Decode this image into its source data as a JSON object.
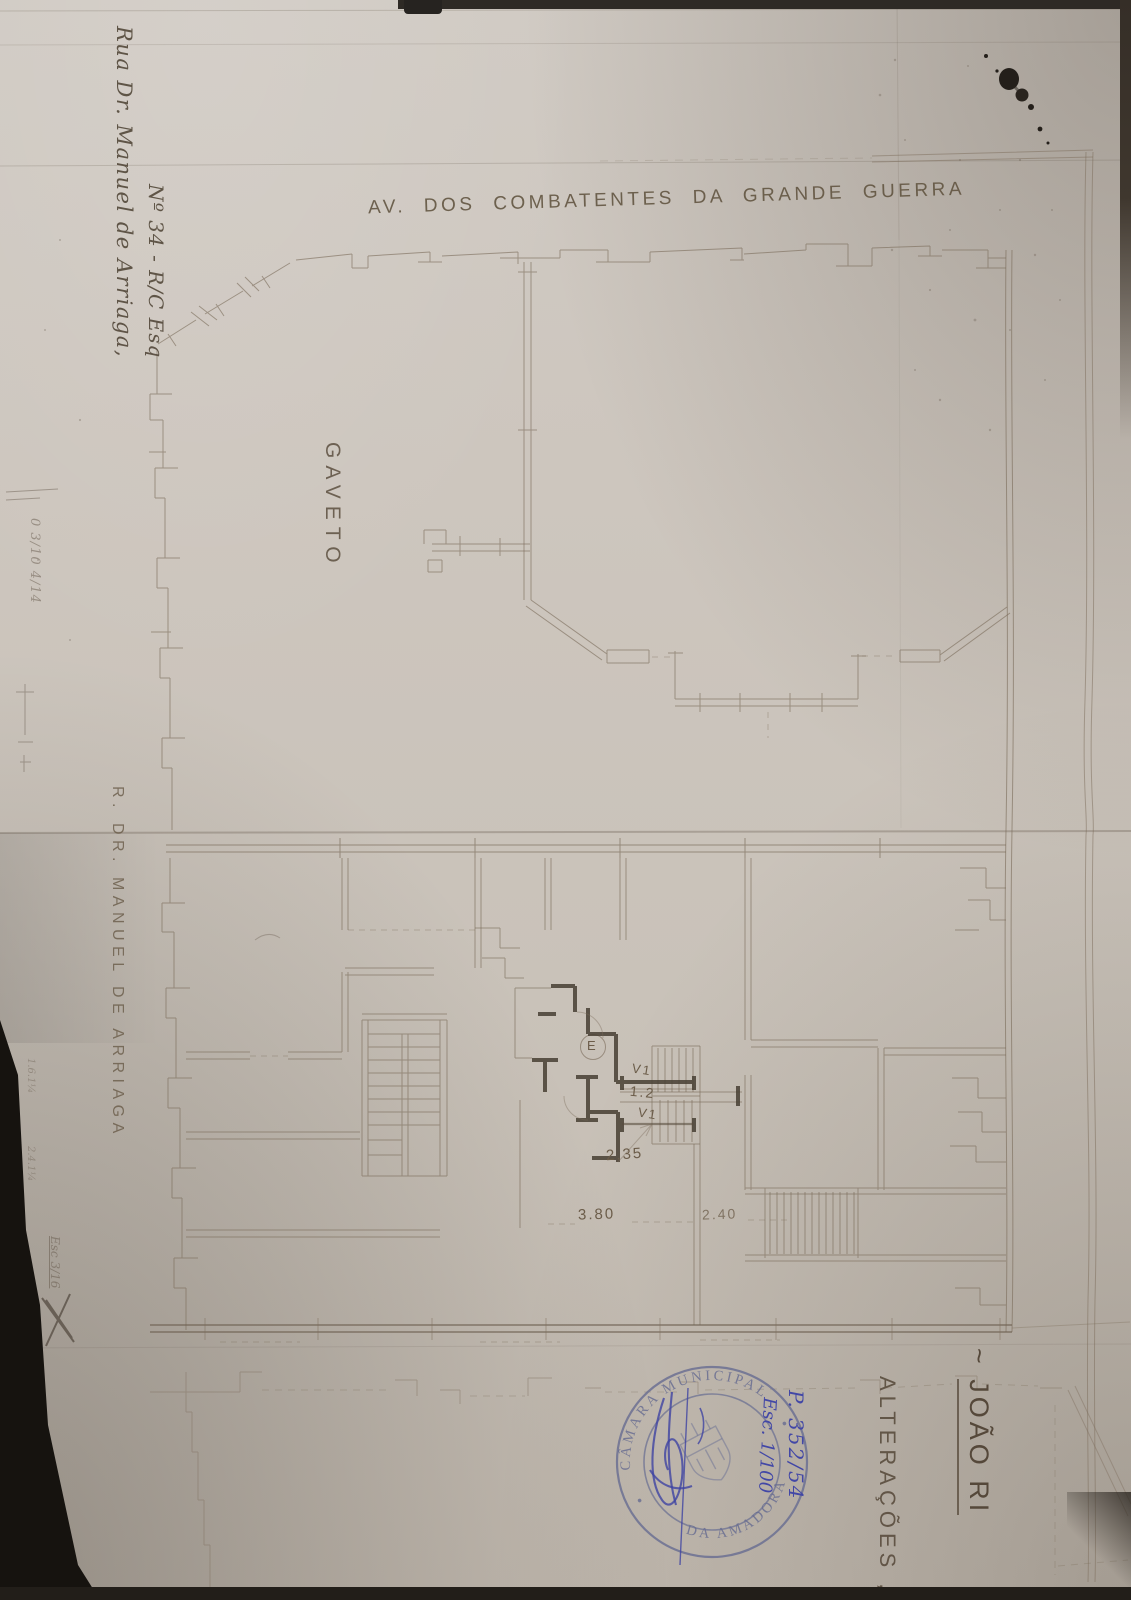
{
  "annotations": {
    "street_top": "AV. DOS COMBATENTES DA GRANDE GUERRA",
    "corner_label": "GAVETO",
    "street_left": "R. DR. MANUEL DE ARRIAGA",
    "address_line1": "Rua Dr. Manuel de Arriaga,",
    "address_line2": "Nº 34 - R/C Esq",
    "owner_tilde": "~ ",
    "owner_name": "JOÃO RI",
    "subject": "ALTERAÇÕES ,",
    "process_number": "P. 352/54",
    "scale_blue": "Esc. 1/100",
    "pencil_note_top": "0 3/10 4/14",
    "pencil_note_a": "1.6.1¼",
    "pencil_note_b": "2.4.1¼",
    "pencil_note_scale": "Esc 3/16"
  },
  "stamp": {
    "arc_top": "CÂMARA MUNICIPAL",
    "arc_bottom": "DA AMADORA"
  },
  "plan_labels": {
    "elevator": "E",
    "window_1": "V1",
    "dim_corridor": "1.2",
    "window_2": "V1",
    "dim_235": "2.35",
    "dim_380": "3.80",
    "dim_240": "2.40"
  }
}
